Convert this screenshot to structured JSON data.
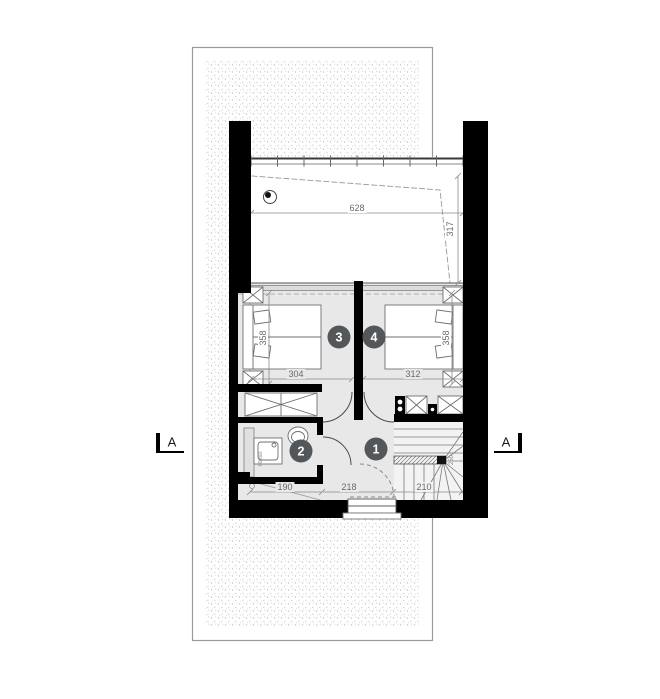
{
  "rooms": [
    {
      "number": "1"
    },
    {
      "number": "2"
    },
    {
      "number": "3"
    },
    {
      "number": "4"
    }
  ],
  "dimensions": {
    "terrace_width": "628",
    "terrace_depth": "317",
    "bedroom3_width": "304",
    "bedroom4_width": "312",
    "bedroom3_depth": "358",
    "bedroom4_depth": "358",
    "bathroom_width": "190",
    "hall_width": "218",
    "stair_width": "210",
    "stair_flight": "250",
    "washer_size": "60x60"
  },
  "section_markers": {
    "left": "A",
    "right": "A"
  },
  "colors": {
    "wall": "#000000",
    "floor": "#e8e8e8",
    "terrace_floor": "#ffffff",
    "room_badge": "#53575a",
    "dim_text": "#6a6a6a",
    "plot_boundary": "#9a9a9a"
  }
}
